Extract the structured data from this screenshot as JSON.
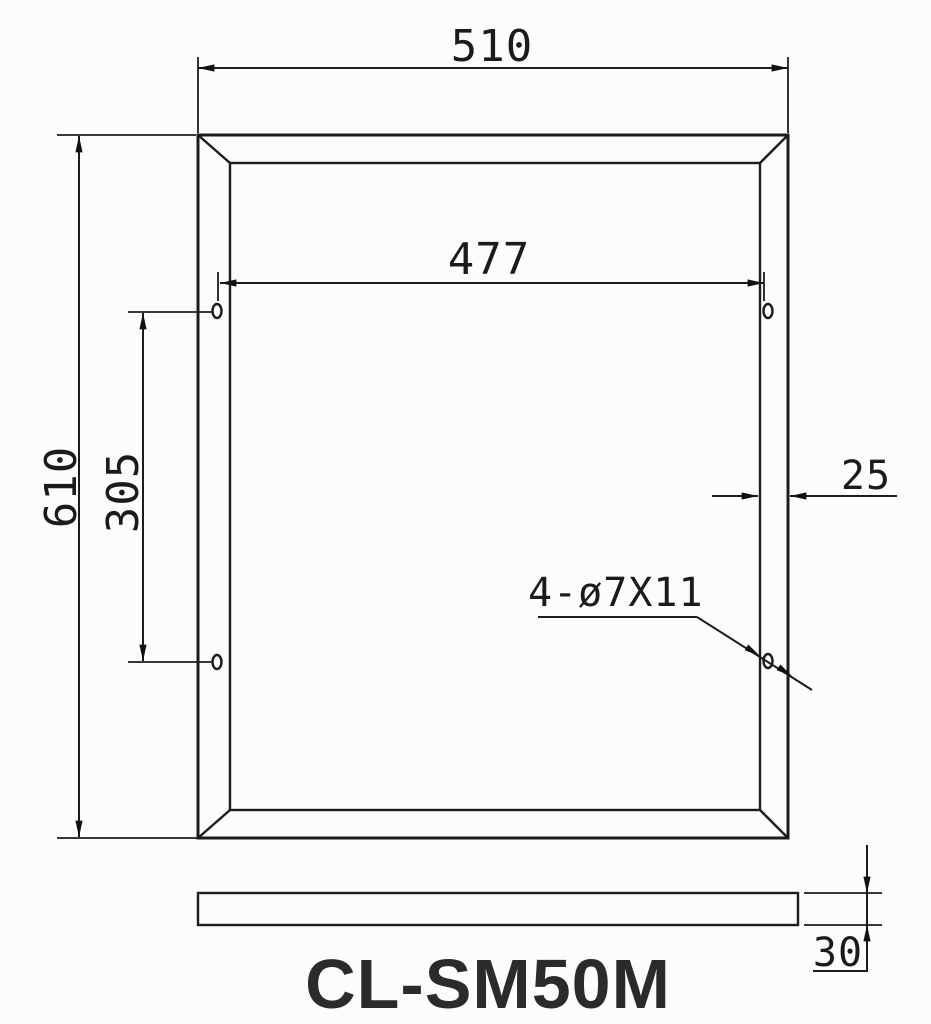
{
  "drawing": {
    "title": "CL-SM50M",
    "dims": {
      "outer_width": "510",
      "outer_height": "610",
      "hole_span_h": "477",
      "hole_span_v": "305",
      "frame_face": "25",
      "holes_callout": "4-ø7X11",
      "profile_thickness": "30"
    },
    "colors": {
      "line": "#1c1c1c",
      "text": "#1b1b1b",
      "title": "#2b2b2b",
      "background": "#fcfcfb"
    }
  }
}
